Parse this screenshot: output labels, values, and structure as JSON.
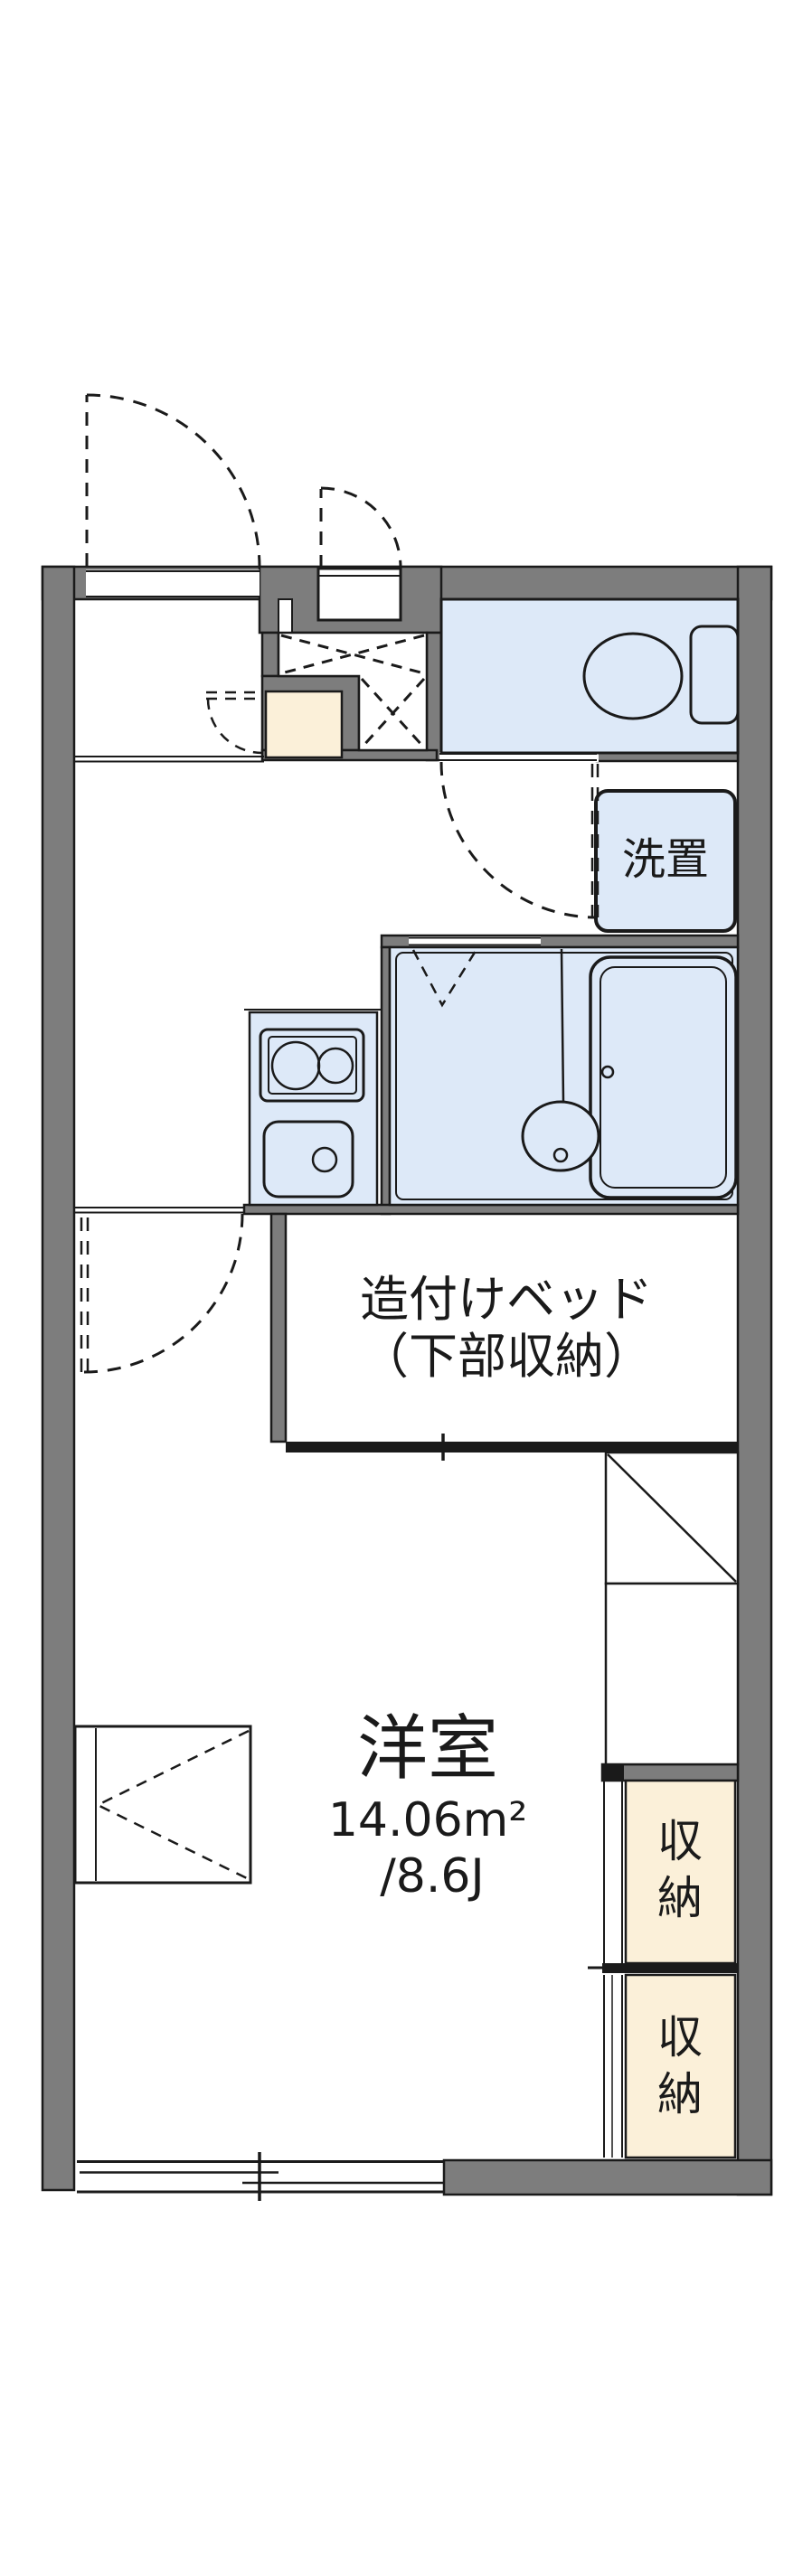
{
  "floor_plan": {
    "texts": {
      "bed_line1": "造付けベッド",
      "bed_line2": "（下部収納）",
      "washstand": "洗置",
      "room_name": "洋室",
      "area_m2": "14.06m²",
      "area_jo": "/8.6J",
      "storage_upper_char1": "収",
      "storage_upper_char2": "納",
      "storage_lower_char1": "収",
      "storage_lower_char2": "納"
    },
    "colors": {
      "wall_fill": "#7d7d7d",
      "water_area_fill": "#dde9f8",
      "storage_fill": "#fbf0d9",
      "line": "#1a1a1a",
      "background": "#ffffff"
    }
  }
}
